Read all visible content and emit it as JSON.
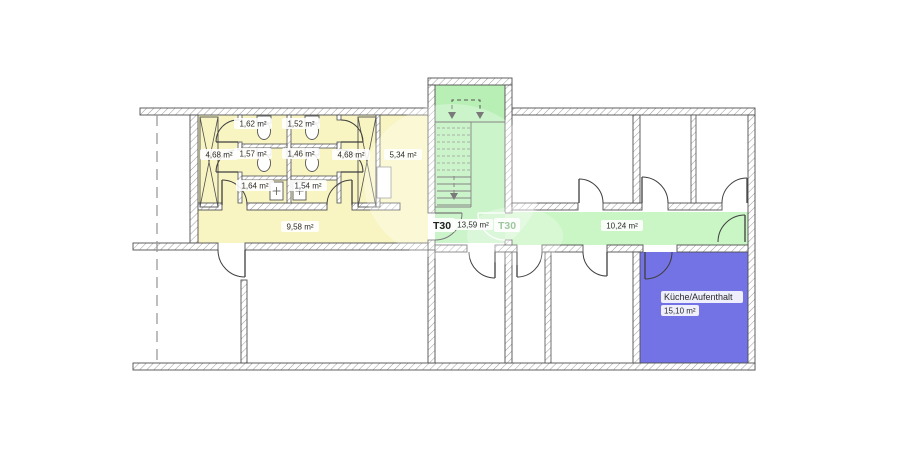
{
  "colors": {
    "background": "#ffffff",
    "wc_area_fill": "#f8f5c3",
    "stairwell_fill": "#b7efb5",
    "corridor_fill": "#c9f6c4",
    "kitchen_fill": "#7473e5",
    "wall_outline": "#4f4f4f",
    "label_text": "#2b2b2b",
    "faded_label_text": "#9fc79f"
  },
  "rooms": {
    "wc_stall_top_left": {
      "area": "1,62 m²"
    },
    "wc_stall_top_right": {
      "area": "1,52 m²"
    },
    "wc_stall_mid_left": {
      "area": "1,57 m²"
    },
    "wc_stall_mid_right": {
      "area": "1,46 m²"
    },
    "wc_lobby_left": {
      "area": "4,68 m²"
    },
    "wc_lobby_right": {
      "area": "4,68 m²"
    },
    "wc_ante_left": {
      "area": "1,64 m²"
    },
    "wc_ante_right": {
      "area": "1,54 m²"
    },
    "side_room": {
      "area": "5,34 m²"
    },
    "wc_corridor": {
      "area": "9,58 m²"
    },
    "stairwell": {
      "area": "13,59 m²"
    },
    "corridor": {
      "area": "10,24 m²"
    },
    "kitchen": {
      "name": "Küche/Aufenthalt",
      "area": "15,10 m²"
    }
  },
  "door_labels": {
    "stair_door_left": "T30",
    "stair_door_right": "T30"
  }
}
